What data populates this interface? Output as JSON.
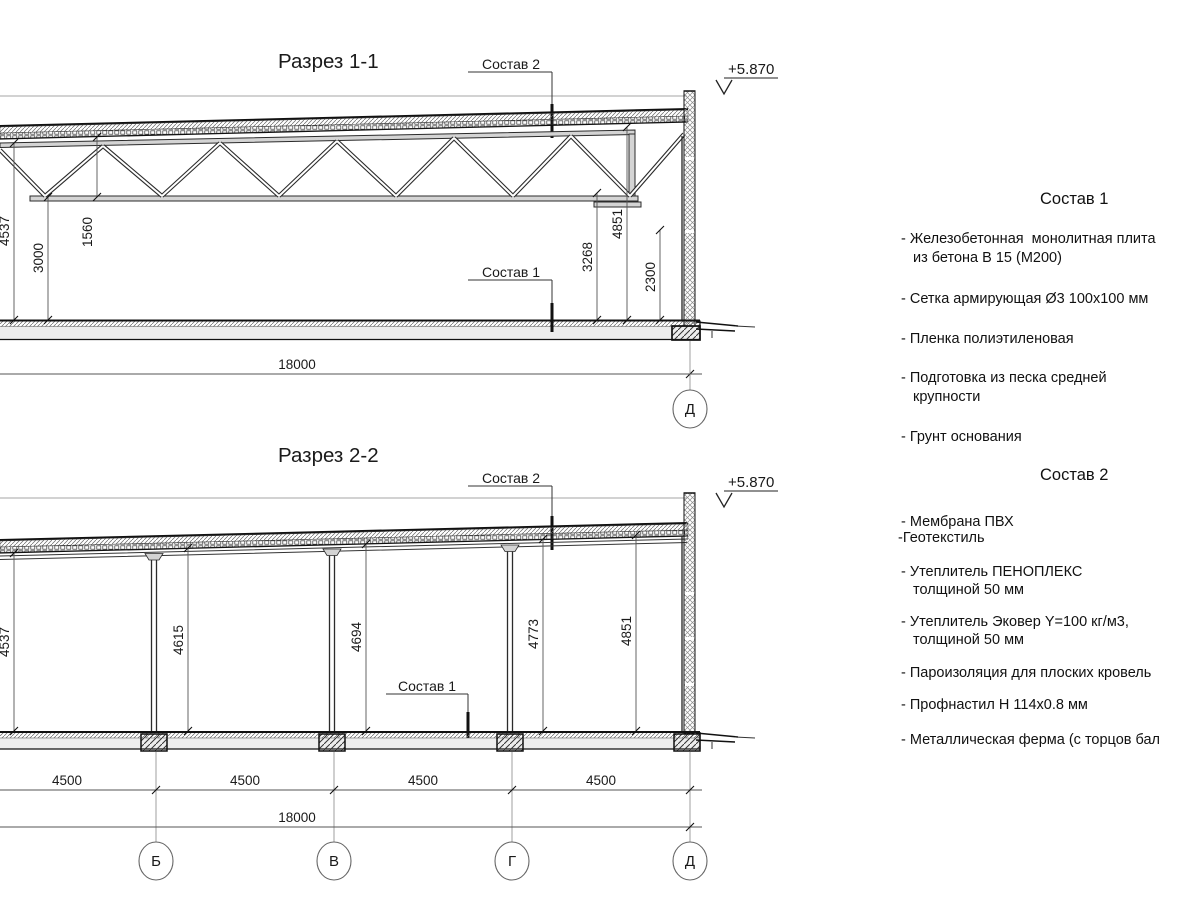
{
  "section1": {
    "title": "Разрез 1-1",
    "callout_top": "Состав 2",
    "callout_floor": "Состав 1",
    "elevation": "+5.870",
    "dim_left_total": "4537",
    "dim_left_clear": "3000",
    "dim_truss": "1560",
    "dim_right_clear": "3268",
    "dim_right_total": "4851",
    "dim_wall_panel": "2300",
    "dim_span": "18000",
    "grid_label": "Д"
  },
  "section2": {
    "title": "Разрез 2-2",
    "callout_top": "Состав 2",
    "callout_floor": "Состав 1",
    "elevation": "+5.870",
    "dim_col_1": "4537",
    "dim_col_2": "4615",
    "dim_col_3": "4694",
    "dim_col_4": "4773",
    "dim_col_5": "4851",
    "dim_bay": "4500",
    "dim_span": "18000",
    "grid_labels": [
      "Б",
      "В",
      "Г",
      "Д"
    ]
  },
  "legend1": {
    "heading": "Состав 1",
    "item1_line1": "- Железобетонная  монолитная плита",
    "item1_line2": "из бетона В 15 (М200)",
    "item2": "- Сетка армирующая Ø3 100х100 мм",
    "item3": "- Пленка полиэтиленовая",
    "item4_line1": "- Подготовка из песка средней",
    "item4_line2": "крупности",
    "item5": "- Грунт основания"
  },
  "legend2": {
    "heading": "Состав 2",
    "item1": "- Мембрана ПВХ",
    "item2": "-Геотекстиль",
    "item3_line1": "- Утеплитель ПЕНОПЛЕКС",
    "item3_line2": "толщиной 50 мм",
    "item4_line1": "- Утеплитель Эковер Y=100 кг/м3,",
    "item4_line2": "толщиной 50 мм",
    "item5": "- Пароизоляция для плоских кровель",
    "item6": "- Профнастил Н 114х0.8 мм",
    "item7": "- Металлическая ферма (с торцов бал"
  }
}
